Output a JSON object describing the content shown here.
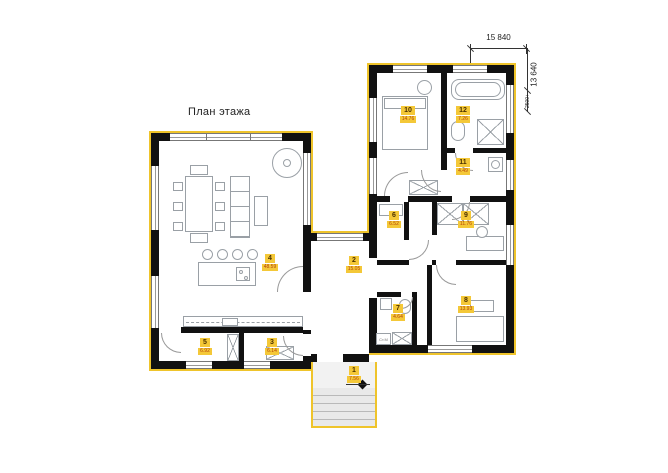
{
  "title": "План этажа",
  "dimensions": {
    "width": "15 840",
    "height": "13 640",
    "secondary": "2500+"
  },
  "rooms": [
    {
      "number": "1",
      "area": "7.56"
    },
    {
      "number": "2",
      "area": "15.05"
    },
    {
      "number": "3",
      "area": "6.14"
    },
    {
      "number": "4",
      "area": "48.59"
    },
    {
      "number": "5",
      "area": "6.92"
    },
    {
      "number": "6",
      "area": "6.52"
    },
    {
      "number": "7",
      "area": "4.64"
    },
    {
      "number": "8",
      "area": "13.93"
    },
    {
      "number": "9",
      "area": "11.76"
    },
    {
      "number": "10",
      "area": "14.76"
    },
    {
      "number": "11",
      "area": "4.49"
    },
    {
      "number": "12",
      "area": "7.26"
    }
  ],
  "annotations": {
    "washer": "Ст.М"
  },
  "colors": {
    "wall": "#111111",
    "accent_yellow": "#EFC42B",
    "label_background": "#F4C838",
    "room_number_text": "#4A3000",
    "room_area_text": "#B4420A"
  }
}
